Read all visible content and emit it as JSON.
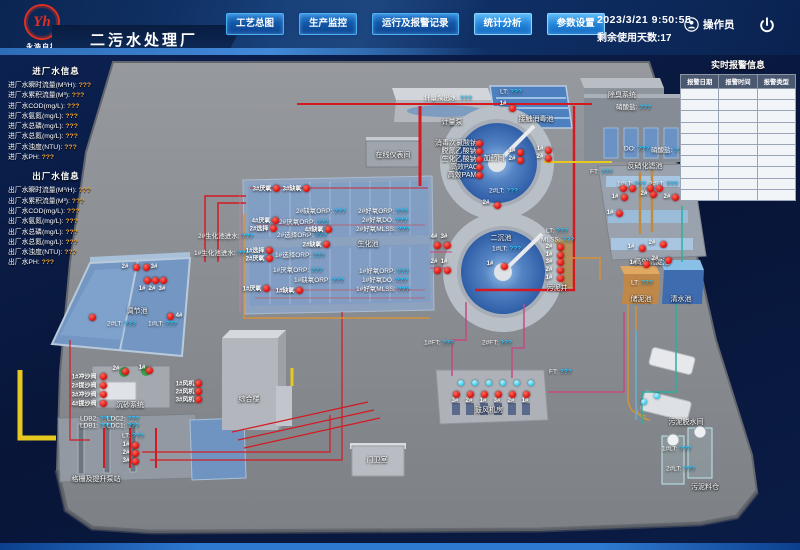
{
  "header": {
    "logo_monogram": "Yh",
    "logo_text": "永浩自控",
    "title": "二污水处理厂",
    "nav": [
      {
        "label": "工艺总图"
      },
      {
        "label": "生产监控"
      },
      {
        "label": "运行及报警记录"
      },
      {
        "label": "统计分析"
      },
      {
        "label": "参数设置"
      }
    ],
    "datetime": "2023/3/21  9:50:55",
    "remaining_days": "剩余使用天数:17",
    "operator": "操作员"
  },
  "sidebar": {
    "in_title": "进厂水信息",
    "in_items": [
      {
        "label": "进厂水瞬时流量(M³/H):",
        "value": "???"
      },
      {
        "label": "进厂水累积流量(M³):",
        "value": "???"
      },
      {
        "label": "进厂水COD(mg/L):",
        "value": "???"
      },
      {
        "label": "进厂水氨氮(mg/L):",
        "value": "???"
      },
      {
        "label": "进厂水总磷(mg/L):",
        "value": "???"
      },
      {
        "label": "进厂水总氮(mg/L):",
        "value": "???"
      },
      {
        "label": "进厂水浊度(NTU):",
        "value": "???"
      },
      {
        "label": "进厂水PH:",
        "value": "???"
      }
    ],
    "out_title": "出厂水信息",
    "out_items": [
      {
        "label": "出厂水瞬时流量(M³/H):",
        "value": "???"
      },
      {
        "label": "出厂水累积流量(M³):",
        "value": "???"
      },
      {
        "label": "出厂水COD(mg/L):",
        "value": "???"
      },
      {
        "label": "出厂水氨氮(mg/L):",
        "value": "???"
      },
      {
        "label": "出厂水总磷(mg/L):",
        "value": "???"
      },
      {
        "label": "出厂水总氮(mg/L):",
        "value": "???"
      },
      {
        "label": "出厂水浊度(NTU):",
        "value": "???"
      },
      {
        "label": "出厂水PH:",
        "value": "???"
      }
    ]
  },
  "alarm_panel": {
    "title": "实时报警信息",
    "columns": [
      "报警日期",
      "报警时间",
      "报警类型"
    ],
    "empty_rows": 10
  },
  "colors": {
    "value_cyan": "#2bc8ff",
    "sidebar_orange": "#f0a43c",
    "alarm_red": "#d80c0c"
  },
  "plant": {
    "names": [
      {
        "t": "计量泵",
        "x": 452,
        "y": 122
      },
      {
        "t": "在线仪表间",
        "x": 393,
        "y": 155
      },
      {
        "t": "加药间",
        "x": 494,
        "y": 158
      },
      {
        "t": "接触消毒池",
        "x": 536,
        "y": 119
      },
      {
        "t": "除臭系统",
        "x": 622,
        "y": 95
      },
      {
        "t": "反硝化滤池",
        "x": 645,
        "y": 166
      },
      {
        "t": "高效沉淀池",
        "x": 652,
        "y": 262
      },
      {
        "t": "储泥池",
        "x": 641,
        "y": 299
      },
      {
        "t": "清水池",
        "x": 681,
        "y": 299
      },
      {
        "t": "污泥井",
        "x": 557,
        "y": 288
      },
      {
        "t": "二沉池",
        "x": 501,
        "y": 238
      },
      {
        "t": "生化池",
        "x": 368,
        "y": 244
      },
      {
        "t": "调节池",
        "x": 137,
        "y": 311
      },
      {
        "t": "沉砂系统",
        "x": 130,
        "y": 405
      },
      {
        "t": "格栅及提升泵站",
        "x": 96,
        "y": 479
      },
      {
        "t": "综合楼",
        "x": 249,
        "y": 399
      },
      {
        "t": "门卫室",
        "x": 377,
        "y": 460
      },
      {
        "t": "鼓风机房",
        "x": 489,
        "y": 410
      },
      {
        "t": "污泥脱水间",
        "x": 686,
        "y": 422
      },
      {
        "t": "污泥料仓",
        "x": 705,
        "y": 487
      },
      {
        "t": "消毒次氯酸钠",
        "x": 456,
        "y": 143
      },
      {
        "t": "脱氮乙酸钠",
        "x": 459,
        "y": 151
      },
      {
        "t": "生化乙酸钠",
        "x": 459,
        "y": 159
      },
      {
        "t": "高效PAC",
        "x": 464,
        "y": 167
      },
      {
        "t": "高效PAM",
        "x": 462,
        "y": 175
      }
    ],
    "values": [
      {
        "t": "计量泵出水:",
        "v": "???",
        "x": 424,
        "y": 97
      },
      {
        "t": "LT:",
        "v": "???",
        "x": 500,
        "y": 92
      },
      {
        "t": "硝酸盐:",
        "v": "???",
        "x": 616,
        "y": 106
      },
      {
        "t": "DO:",
        "v": "???",
        "x": 624,
        "y": 149
      },
      {
        "t": "硝酸盐:",
        "v": "???",
        "x": 651,
        "y": 149
      },
      {
        "t": "FT:",
        "v": "???",
        "x": 590,
        "y": 172
      },
      {
        "t": "1#LT:",
        "v": "???",
        "x": 617,
        "y": 184
      },
      {
        "t": "2#LT:",
        "v": "???",
        "x": 649,
        "y": 184
      },
      {
        "t": "LT:",
        "v": "???",
        "x": 546,
        "y": 231
      },
      {
        "t": "MLSS:",
        "v": "???",
        "x": 541,
        "y": 240
      },
      {
        "t": "2#LT:",
        "v": "???",
        "x": 489,
        "y": 191
      },
      {
        "t": "1#LT:",
        "v": "???",
        "x": 492,
        "y": 249
      },
      {
        "t": "FT:",
        "v": "???",
        "x": 549,
        "y": 372
      },
      {
        "t": "1#FT:",
        "v": "???",
        "x": 424,
        "y": 343
      },
      {
        "t": "2#FT:",
        "v": "???",
        "x": 482,
        "y": 343
      },
      {
        "t": "2#好氧ORP:",
        "v": "???",
        "x": 358,
        "y": 210
      },
      {
        "t": "2#好氧DO:",
        "v": "???",
        "x": 362,
        "y": 219
      },
      {
        "t": "2#好氧MLSS:",
        "v": "???",
        "x": 356,
        "y": 228
      },
      {
        "t": "1#好氧ORP:",
        "v": "???",
        "x": 359,
        "y": 270
      },
      {
        "t": "1#好氧DO:",
        "v": "???",
        "x": 362,
        "y": 279
      },
      {
        "t": "1#好氧MLSS:",
        "v": "???",
        "x": 356,
        "y": 288
      },
      {
        "t": "2#缺氧ORP:",
        "v": "???",
        "x": 296,
        "y": 210
      },
      {
        "t": "2#厌氧ORP:",
        "v": "???",
        "x": 279,
        "y": 221
      },
      {
        "t": "2#选择ORP:",
        "v": "???",
        "x": 277,
        "y": 234
      },
      {
        "t": "1#选择ORP:",
        "v": "???",
        "x": 275,
        "y": 254
      },
      {
        "t": "1#厌氧ORP:",
        "v": "???",
        "x": 273,
        "y": 269
      },
      {
        "t": "1#缺氧ORP:",
        "v": "???",
        "x": 294,
        "y": 279
      },
      {
        "t": "2#生化池进水:",
        "v": "???",
        "x": 198,
        "y": 235
      },
      {
        "t": "1#生化池进水:",
        "v": "???",
        "x": 194,
        "y": 252
      },
      {
        "t": "2#LT:",
        "v": "???",
        "x": 107,
        "y": 324
      },
      {
        "t": "1#LT:",
        "v": "???",
        "x": 148,
        "y": 324
      },
      {
        "t": "LDB2:",
        "v": "???",
        "x": 80,
        "y": 419
      },
      {
        "t": "LDC2:",
        "v": "???",
        "x": 107,
        "y": 419
      },
      {
        "t": "LDB1:",
        "v": "???",
        "x": 80,
        "y": 426
      },
      {
        "t": "LDC1:",
        "v": "???",
        "x": 107,
        "y": 426
      },
      {
        "t": "LT:",
        "v": "???",
        "x": 122,
        "y": 436
      },
      {
        "t": "LT:",
        "v": "???",
        "x": 631,
        "y": 283
      },
      {
        "t": "1#LT:",
        "v": "???",
        "x": 662,
        "y": 449
      },
      {
        "t": "2#LT:",
        "v": "???",
        "x": 666,
        "y": 469
      }
    ],
    "tags": [
      {
        "t": "3#厌氧",
        "x": 262,
        "y": 188
      },
      {
        "t": "3#缺氧",
        "x": 292,
        "y": 188
      },
      {
        "t": "4#厌氧",
        "x": 261,
        "y": 220
      },
      {
        "t": "2#选择",
        "x": 259,
        "y": 228
      },
      {
        "t": "4#缺氧",
        "x": 314,
        "y": 229
      },
      {
        "t": "2#缺氧",
        "x": 312,
        "y": 244
      },
      {
        "t": "1#选择",
        "x": 255,
        "y": 250
      },
      {
        "t": "2#厌氧",
        "x": 255,
        "y": 258
      },
      {
        "t": "1#厌氧",
        "x": 252,
        "y": 288
      },
      {
        "t": "1#缺氧",
        "x": 285,
        "y": 290
      },
      {
        "t": "1#",
        "x": 503,
        "y": 104
      },
      {
        "t": "1#",
        "x": 512,
        "y": 151
      },
      {
        "t": "2#",
        "x": 512,
        "y": 159
      },
      {
        "t": "1#",
        "x": 540,
        "y": 149
      },
      {
        "t": "2#",
        "x": 540,
        "y": 157
      },
      {
        "t": "1#",
        "x": 615,
        "y": 197
      },
      {
        "t": "2#",
        "x": 644,
        "y": 194
      },
      {
        "t": "2#",
        "x": 667,
        "y": 197
      },
      {
        "t": "1#",
        "x": 610,
        "y": 213
      },
      {
        "t": "1#",
        "x": 631,
        "y": 247
      },
      {
        "t": "2#",
        "x": 652,
        "y": 243
      },
      {
        "t": "1#",
        "x": 633,
        "y": 263
      },
      {
        "t": "2#",
        "x": 655,
        "y": 259
      },
      {
        "t": "2#",
        "x": 486,
        "y": 203
      },
      {
        "t": "1#",
        "x": 490,
        "y": 264
      },
      {
        "t": "4#",
        "x": 434,
        "y": 237
      },
      {
        "t": "3#",
        "x": 444,
        "y": 237
      },
      {
        "t": "2#",
        "x": 434,
        "y": 262
      },
      {
        "t": "1#",
        "x": 444,
        "y": 262
      },
      {
        "t": "2#",
        "x": 549,
        "y": 247
      },
      {
        "t": "1#",
        "x": 549,
        "y": 255
      },
      {
        "t": "3#",
        "x": 549,
        "y": 262
      },
      {
        "t": "2#",
        "x": 549,
        "y": 270
      },
      {
        "t": "1#",
        "x": 549,
        "y": 278
      },
      {
        "t": "2#",
        "x": 125,
        "y": 267
      },
      {
        "t": "3#",
        "x": 154,
        "y": 267
      },
      {
        "t": "1#",
        "x": 142,
        "y": 289
      },
      {
        "t": "2#",
        "x": 152,
        "y": 289
      },
      {
        "t": "3#",
        "x": 162,
        "y": 289
      },
      {
        "t": "4#",
        "x": 179,
        "y": 316
      },
      {
        "t": "2#",
        "x": 116,
        "y": 369
      },
      {
        "t": "1#",
        "x": 142,
        "y": 368
      },
      {
        "t": "1#冲沙阀",
        "x": 84,
        "y": 376
      },
      {
        "t": "2#提沙阀",
        "x": 84,
        "y": 385
      },
      {
        "t": "3#冲沙阀",
        "x": 84,
        "y": 394
      },
      {
        "t": "4#提沙阀",
        "x": 84,
        "y": 403
      },
      {
        "t": "1#风机",
        "x": 185,
        "y": 383
      },
      {
        "t": "2#风机",
        "x": 185,
        "y": 391
      },
      {
        "t": "3#风机",
        "x": 185,
        "y": 399
      },
      {
        "t": "1#",
        "x": 126,
        "y": 445
      },
      {
        "t": "2#",
        "x": 126,
        "y": 453
      },
      {
        "t": "3#",
        "x": 126,
        "y": 461
      },
      {
        "t": "3#",
        "x": 455,
        "y": 401
      },
      {
        "t": "2#",
        "x": 469,
        "y": 401
      },
      {
        "t": "1#",
        "x": 483,
        "y": 401
      },
      {
        "t": "3#",
        "x": 497,
        "y": 401
      },
      {
        "t": "2#",
        "x": 511,
        "y": 401
      },
      {
        "t": "1#",
        "x": 525,
        "y": 401
      }
    ],
    "dots": {
      "red": [
        [
          276,
          188
        ],
        [
          306,
          188
        ],
        [
          275,
          220
        ],
        [
          273,
          228
        ],
        [
          328,
          229
        ],
        [
          326,
          244
        ],
        [
          269,
          250
        ],
        [
          269,
          258
        ],
        [
          266,
          288
        ],
        [
          299,
          290
        ],
        [
          479,
          143
        ],
        [
          479,
          151
        ],
        [
          479,
          159
        ],
        [
          479,
          167
        ],
        [
          479,
          175
        ],
        [
          512,
          108
        ],
        [
          520,
          152
        ],
        [
          520,
          160
        ],
        [
          548,
          150
        ],
        [
          548,
          158
        ],
        [
          624,
          197
        ],
        [
          653,
          194
        ],
        [
          675,
          197
        ],
        [
          619,
          213
        ],
        [
          642,
          248
        ],
        [
          663,
          244
        ],
        [
          646,
          264
        ],
        [
          668,
          260
        ],
        [
          623,
          188
        ],
        [
          632,
          188
        ],
        [
          650,
          188
        ],
        [
          659,
          188
        ],
        [
          497,
          205
        ],
        [
          504,
          266
        ],
        [
          437,
          245
        ],
        [
          447,
          245
        ],
        [
          437,
          270
        ],
        [
          447,
          270
        ],
        [
          560,
          247
        ],
        [
          560,
          255
        ],
        [
          560,
          262
        ],
        [
          560,
          270
        ],
        [
          560,
          278
        ],
        [
          136,
          267
        ],
        [
          146,
          267
        ],
        [
          147,
          280
        ],
        [
          155,
          280
        ],
        [
          163,
          280
        ],
        [
          170,
          316
        ],
        [
          92,
          317
        ],
        [
          125,
          371
        ],
        [
          149,
          370
        ],
        [
          103,
          376
        ],
        [
          103,
          385
        ],
        [
          103,
          394
        ],
        [
          103,
          403
        ],
        [
          198,
          383
        ],
        [
          198,
          391
        ],
        [
          198,
          399
        ],
        [
          135,
          445
        ],
        [
          135,
          453
        ],
        [
          135,
          461
        ],
        [
          456,
          394
        ],
        [
          470,
          394
        ],
        [
          484,
          394
        ],
        [
          498,
          394
        ],
        [
          512,
          394
        ],
        [
          526,
          394
        ]
      ],
      "cyan": [
        [
          461,
          383
        ],
        [
          475,
          383
        ],
        [
          489,
          383
        ],
        [
          503,
          383
        ],
        [
          517,
          383
        ],
        [
          531,
          383
        ],
        [
          644,
          402
        ],
        [
          657,
          396
        ]
      ]
    }
  }
}
